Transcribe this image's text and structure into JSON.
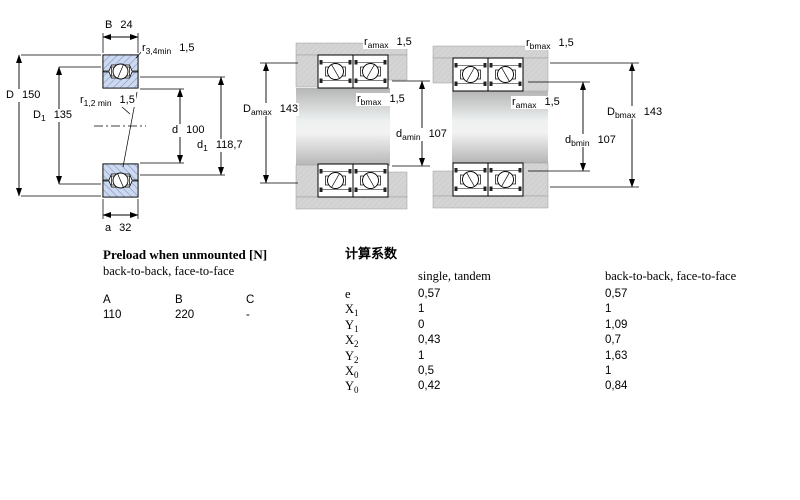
{
  "colors": {
    "bearing_fill": "#cdd9ef",
    "bearing_hatch": "#7f97c6",
    "housing_gray": "#d1d1d1",
    "shaft_gray": "#b5b5b5",
    "line_black": "#000000"
  },
  "dim_labels": [
    {
      "id": "B",
      "main": "B",
      "sub": "",
      "value": "24",
      "x": 104,
      "y": 19
    },
    {
      "id": "r34min",
      "main": "r",
      "sub": "3,4min",
      "value": "1,5",
      "x": 141,
      "y": 42
    },
    {
      "id": "D",
      "main": "D",
      "sub": "",
      "value": "150",
      "x": 5,
      "y": 89
    },
    {
      "id": "D1",
      "main": "D",
      "sub": "1",
      "value": "135",
      "x": 32,
      "y": 109
    },
    {
      "id": "r12min",
      "main": "r",
      "sub": "1,2 min",
      "value": "1,5",
      "x": 79,
      "y": 94
    },
    {
      "id": "d",
      "main": "d",
      "sub": "",
      "value": "100",
      "x": 171,
      "y": 124
    },
    {
      "id": "d1",
      "main": "d",
      "sub": "1",
      "value": "118,7",
      "x": 196,
      "y": 139
    },
    {
      "id": "a",
      "main": "a",
      "sub": "",
      "value": "32",
      "x": 104,
      "y": 222
    },
    {
      "id": "ramax-m",
      "main": "r",
      "sub": "amax",
      "value": "1,5",
      "x": 363,
      "y": 36
    },
    {
      "id": "Damax",
      "main": "D",
      "sub": "amax",
      "value": "143",
      "x": 242,
      "y": 103
    },
    {
      "id": "rbmax-m",
      "main": "r",
      "sub": "bmax",
      "value": "1,5",
      "x": 356,
      "y": 93
    },
    {
      "id": "damin",
      "main": "d",
      "sub": "amin",
      "value": "107",
      "x": 395,
      "y": 128
    },
    {
      "id": "rbmax-r",
      "main": "r",
      "sub": "bmax",
      "value": "1,5",
      "x": 525,
      "y": 37
    },
    {
      "id": "ramax-r",
      "main": "r",
      "sub": "amax",
      "value": "1,5",
      "x": 511,
      "y": 96
    },
    {
      "id": "dbmin",
      "main": "d",
      "sub": "bmin",
      "value": "107",
      "x": 564,
      "y": 134
    },
    {
      "id": "Dbmax",
      "main": "D",
      "sub": "bmax",
      "value": "143",
      "x": 606,
      "y": 106
    }
  ],
  "preload": {
    "title": "Preload when unmounted [N]",
    "subtitle": "back-to-back, face-to-face",
    "headers": [
      "A",
      "B",
      "C"
    ],
    "values": [
      "110",
      "220",
      "-"
    ]
  },
  "factors": {
    "title": "计算系数",
    "col1_header": "single, tandem",
    "col2_header": "back-to-back, face-to-face",
    "rows": [
      {
        "label": "e",
        "sub": "",
        "single": "0,57",
        "btb": "0,57"
      },
      {
        "label": "X",
        "sub": "1",
        "single": "1",
        "btb": "1"
      },
      {
        "label": "Y",
        "sub": "1",
        "single": "0",
        "btb": "1,09"
      },
      {
        "label": "X",
        "sub": "2",
        "single": "0,43",
        "btb": "0,7"
      },
      {
        "label": "Y",
        "sub": "2",
        "single": "1",
        "btb": "1,63"
      },
      {
        "label": "X",
        "sub": "0",
        "single": "0,5",
        "btb": "1"
      },
      {
        "label": "Y",
        "sub": "0",
        "single": "0,42",
        "btb": "0,84"
      }
    ]
  }
}
